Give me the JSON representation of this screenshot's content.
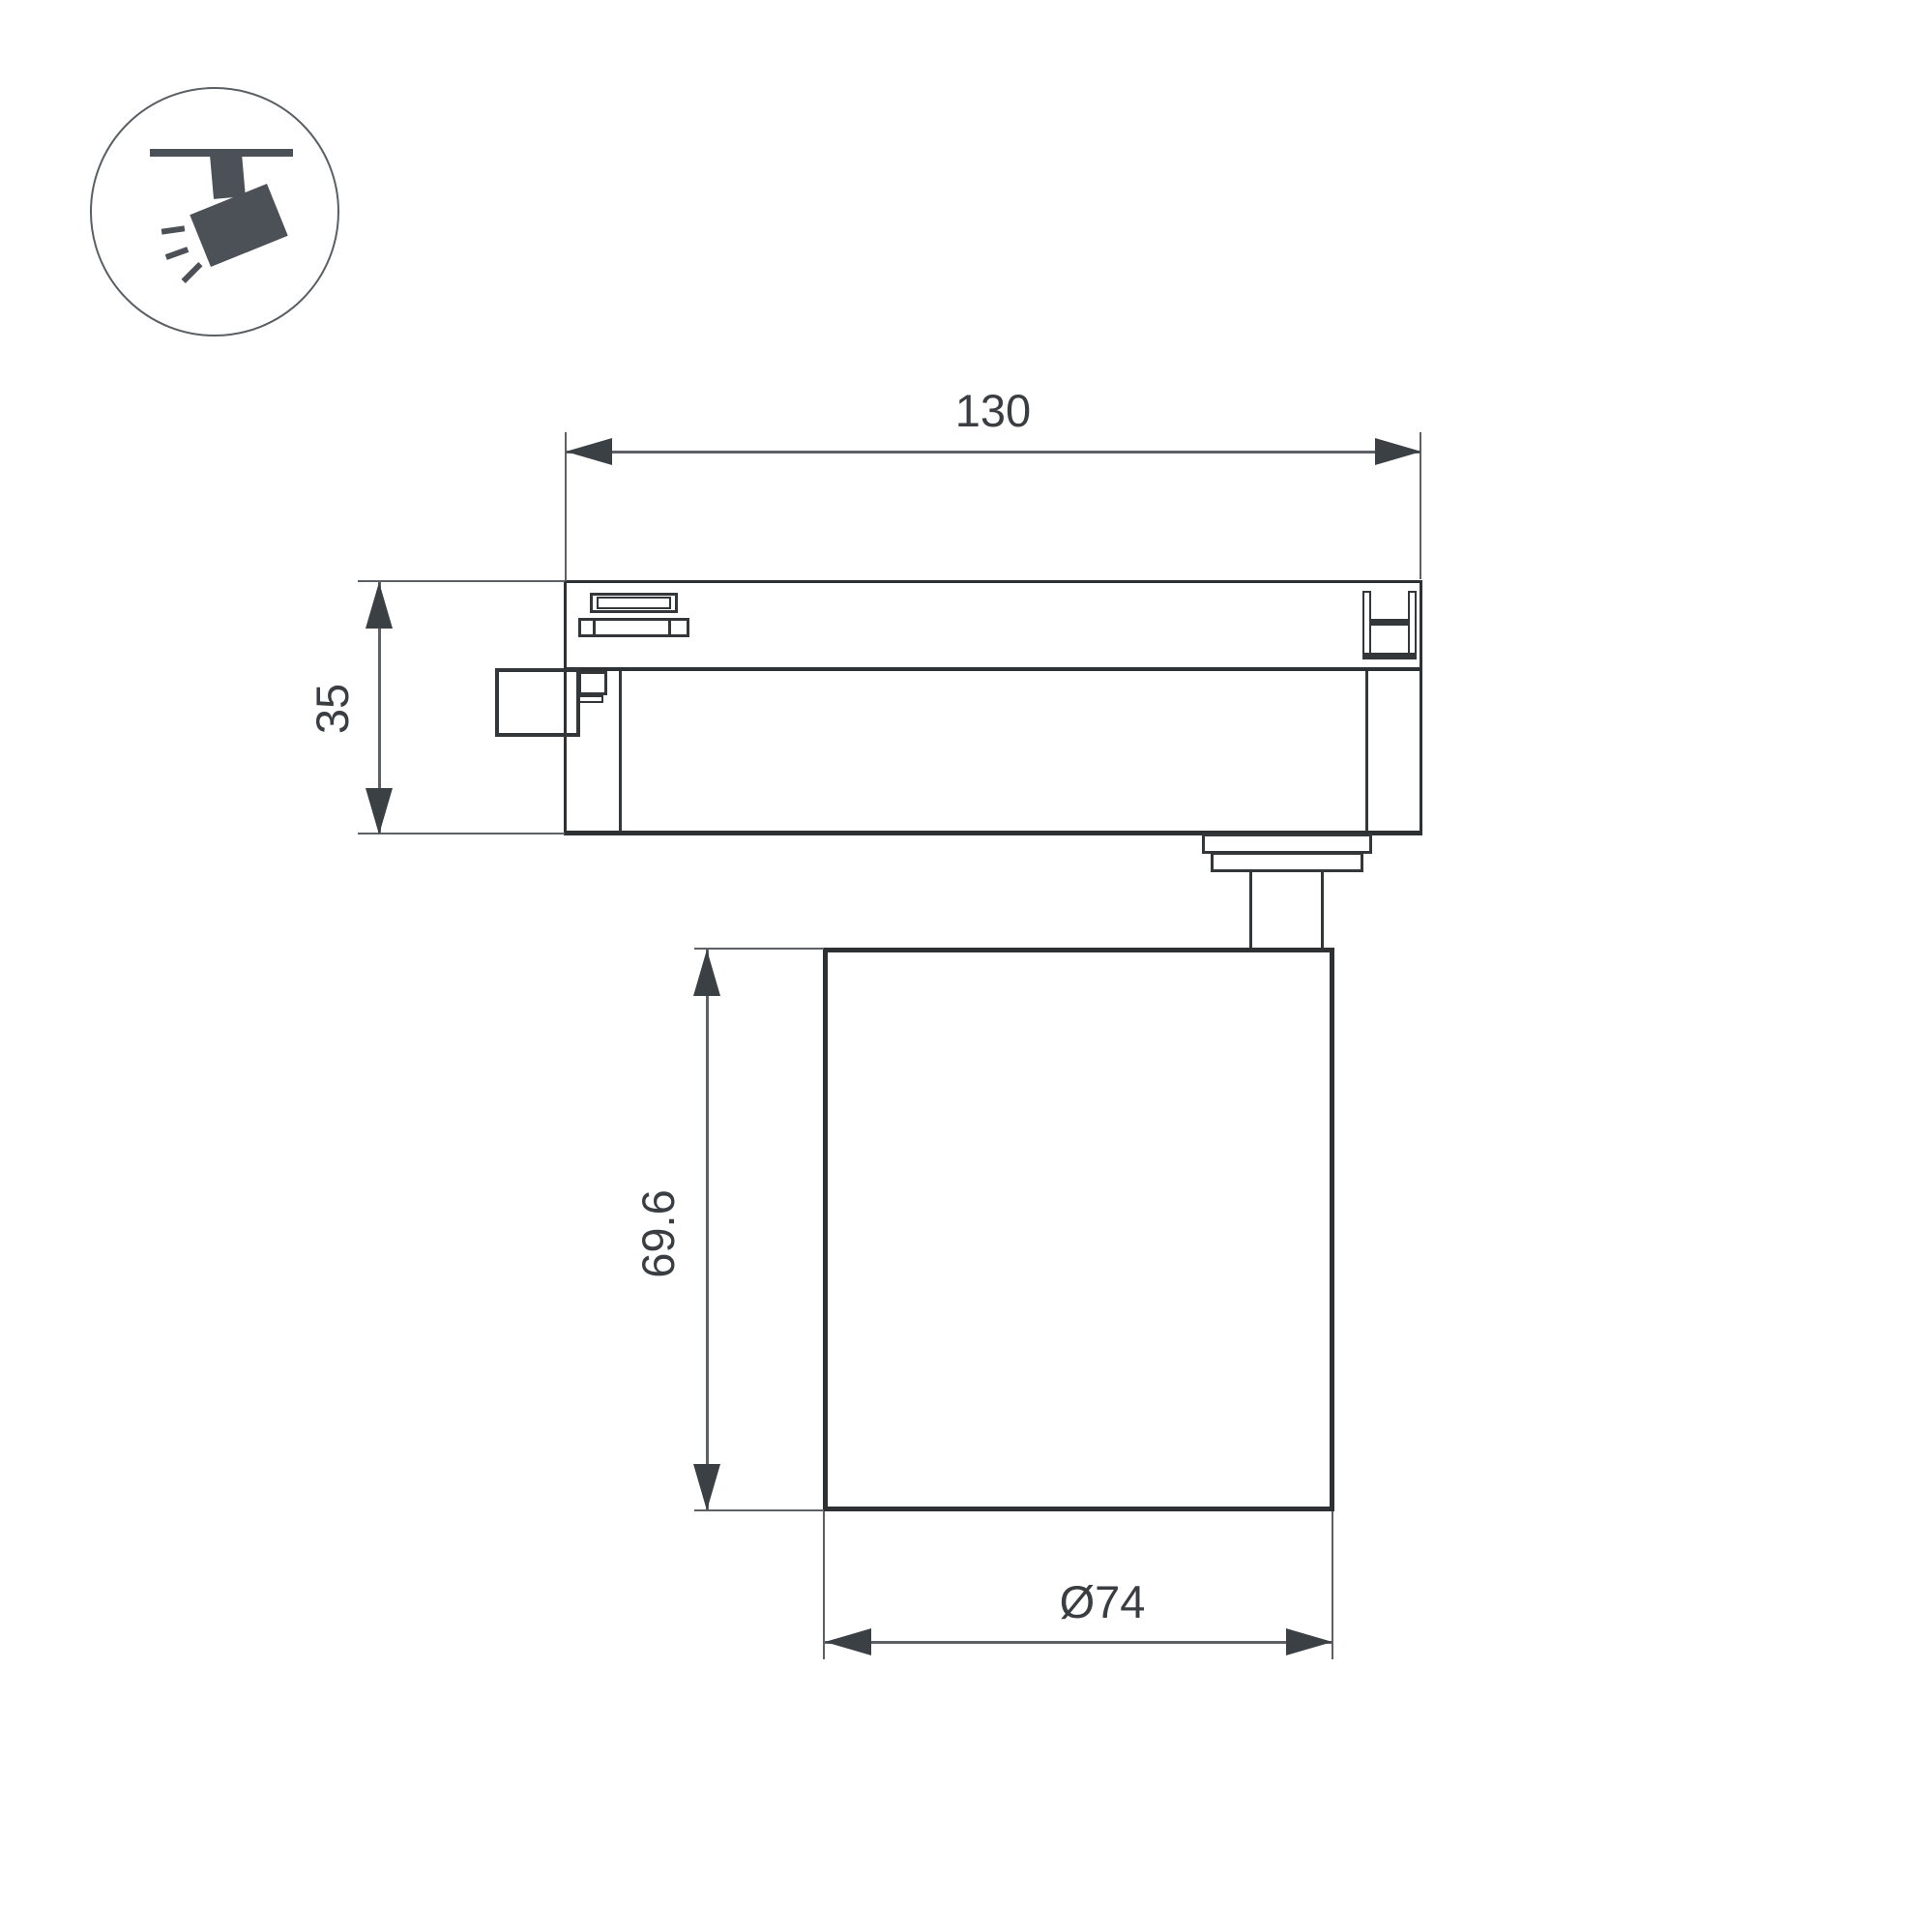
{
  "drawing": {
    "type": "technical-dimension-drawing",
    "subject": "track-mounted spotlight, side view",
    "dimensions": {
      "track_length": "130",
      "adapter_height": "35",
      "body_height": "69.6",
      "body_diameter": "Ø74"
    }
  },
  "colors": {
    "thick_line": "#2d3134",
    "detail_line": "#33373a",
    "thin_line": "#5d6166",
    "arrow_color": "#3b4044",
    "text_color": "#3a3e42",
    "icon_color": "#4b5157",
    "circle_stroke": "#5a5f64",
    "background": "#ffffff"
  }
}
